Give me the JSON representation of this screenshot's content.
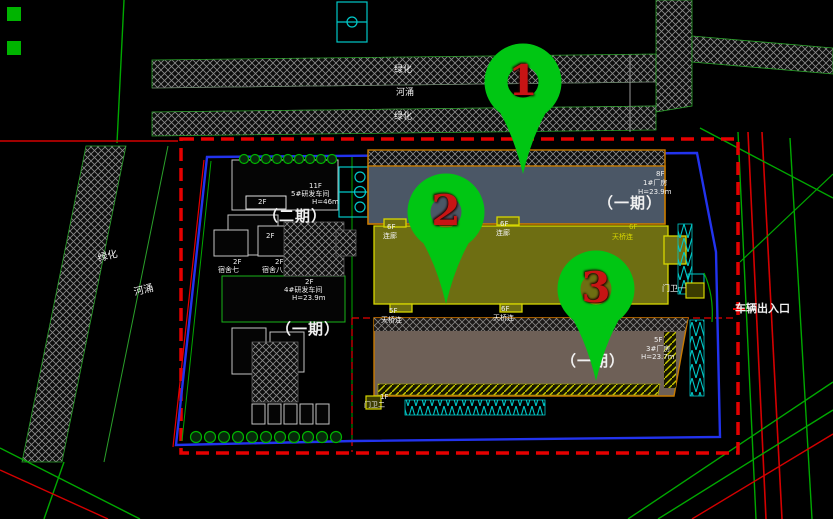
{
  "top_strip": {
    "green1": "绿化",
    "river": "河涌",
    "green2": "绿化"
  },
  "left_strip": {
    "green": "绿化",
    "river": "河涌"
  },
  "phase_labels": {
    "phase2": "（二期）",
    "phase1_west": "（一期）",
    "phase1_b1": "（一期）",
    "phase1_b3": "（一期）"
  },
  "buildings": {
    "b1": {
      "floors": "8F",
      "name": "1#厂房",
      "height": "H=23.9m"
    },
    "b3": {
      "floors": "5F",
      "name": "3#厂房",
      "height": "H=23.7m"
    },
    "rd5": {
      "floors": "11F",
      "name": "5#研发车间",
      "height": "H=46m",
      "annex_floors": "2F"
    },
    "rd4": {
      "floors": "2F",
      "name": "4#研发车间",
      "height": "H=23.9m"
    },
    "yard": {
      "floors": "2F"
    },
    "dorm7": {
      "floors": "2F",
      "name": "宿舍七"
    },
    "dorm8": {
      "floors": "2F",
      "name": "宿舍八"
    },
    "link_left": {
      "floors": "6F",
      "name": "连廊"
    },
    "link_mid": {
      "floors": "6F",
      "name": "连廊"
    },
    "bridge_yellow": {
      "floors": "6F",
      "name": "天桥连"
    },
    "bridge5": {
      "floors": "5F",
      "name": "天桥连"
    },
    "bridge6": {
      "floors": "6F",
      "name": "天桥连"
    },
    "gate1": {
      "name": "门卫一"
    },
    "gate2": {
      "floors": "1F",
      "name": "门卫二"
    }
  },
  "annotations": {
    "vehicle_entrance": "车辆出入口"
  },
  "markers": [
    {
      "number": "1"
    },
    {
      "number": "2"
    },
    {
      "number": "3"
    }
  ],
  "colors": {
    "marker_green": "#00c613",
    "marker_number_red": "#c81414",
    "site_boundary_red": "#e60000",
    "parcel_blue": "#2233ee",
    "building_outline_orange": "#c97b00",
    "cad_yellow": "#d6d600",
    "cad_cyan": "#00c8c8",
    "road_green": "#00a800",
    "text_white": "#f0f0f0"
  }
}
